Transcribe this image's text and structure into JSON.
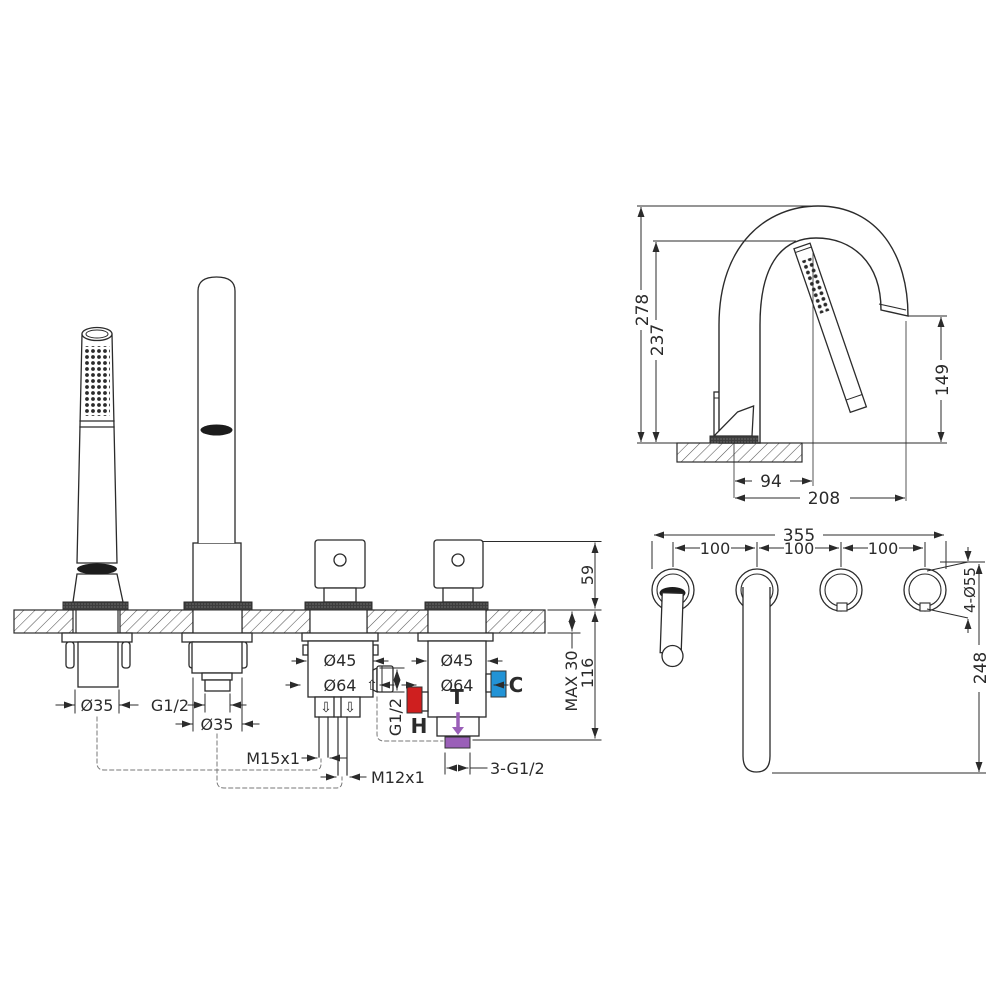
{
  "colors": {
    "line": "#2b2b2b",
    "hot": "#cf1f1f",
    "cold": "#2293d6",
    "mixed": "#9a5fb8"
  },
  "front_view": {
    "handshower_hole_dia": "Ø35",
    "spout_shank_thread": "G1/2",
    "spout_hole_dia": "Ø35",
    "diverter_body_dia": "Ø45",
    "diverter_flange_dia": "Ø64",
    "mixer_body_dia": "Ø45",
    "mixer_flange_dia": "Ø64",
    "hose_thread": "M15x1",
    "rod_thread": "M12x1",
    "side_port_thread": "G1/2",
    "inlet_threads": "3-G1/2",
    "hot_label": "H",
    "cold_label": "C",
    "mixed_label": "T",
    "height_above_deck": "59",
    "height_below_deck": "116",
    "deck_thickness": "MAX 30",
    "flow_up_symbol": "⇧",
    "flow_down_symbol": "⇩"
  },
  "side_view": {
    "total_height": "278",
    "handshower_tip_height": "237",
    "spout_outlet_height": "149",
    "handshower_offset": "94",
    "spout_reach": "208"
  },
  "top_view": {
    "overall_width": "355",
    "hole_spacing_1": "100",
    "hole_spacing_2": "100",
    "hole_spacing_3": "100",
    "hole_count_dia": "4-Ø55",
    "spout_reach": "248"
  }
}
